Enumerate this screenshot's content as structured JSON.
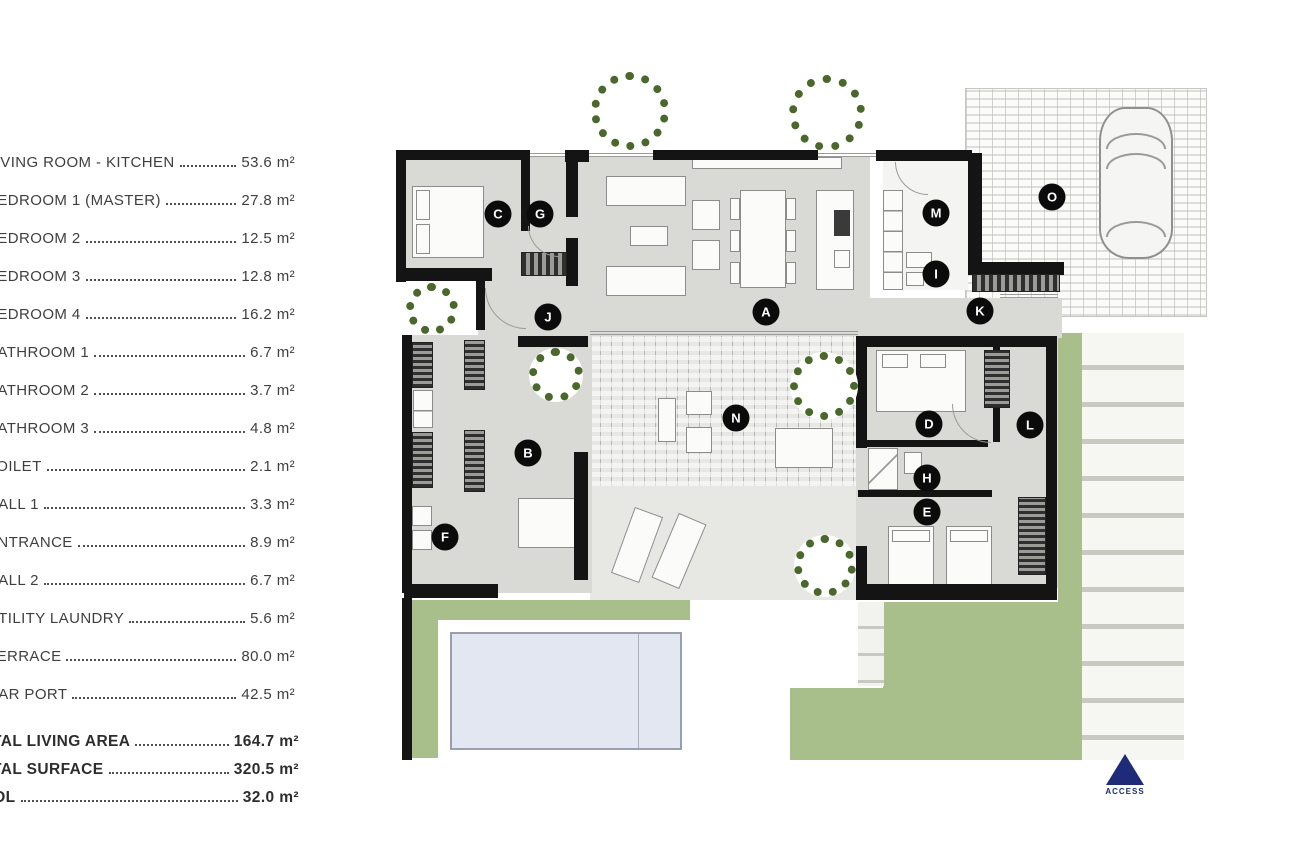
{
  "legend": {
    "unit": "m²",
    "rows": [
      {
        "label": "LIVING ROOM - KITCHEN",
        "value": "53.6 m²"
      },
      {
        "label": "BEDROOM 1 (MASTER)",
        "value": "27.8 m²"
      },
      {
        "label": "BEDROOM 2",
        "value": "12.5 m²"
      },
      {
        "label": "BEDROOM 3",
        "value": "12.8 m²"
      },
      {
        "label": "BEDROOM 4",
        "value": "16.2 m²"
      },
      {
        "label": "BATHROOM 1",
        "value": "6.7 m²"
      },
      {
        "label": "BATHROOM 2",
        "value": "3.7 m²"
      },
      {
        "label": "BATHROOM 3",
        "value": "4.8 m²"
      },
      {
        "label": "TOILET",
        "value": "2.1 m²"
      },
      {
        "label": "HALL 1",
        "value": "3.3 m²"
      },
      {
        "label": "ENTRANCE",
        "value": "8.9 m²"
      },
      {
        "label": "HALL 2",
        "value": "6.7 m²"
      },
      {
        "label": "UTILITY LAUNDRY",
        "value": "5.6 m²"
      },
      {
        "label": "TERRACE",
        "value": "80.0 m²"
      },
      {
        "label": "CAR PORT",
        "value": "42.5 m²"
      }
    ],
    "totals": [
      {
        "label": "TOTAL LIVING AREA",
        "value": "164.7 m²"
      },
      {
        "label": "TOTAL SURFACE",
        "value": "320.5 m²"
      },
      {
        "label": "POOL",
        "value": "32.0 m²"
      }
    ]
  },
  "plan": {
    "markers": [
      {
        "letter": "A",
        "x": 766,
        "y": 312
      },
      {
        "letter": "B",
        "x": 528,
        "y": 453
      },
      {
        "letter": "C",
        "x": 498,
        "y": 214
      },
      {
        "letter": "D",
        "x": 929,
        "y": 424
      },
      {
        "letter": "E",
        "x": 927,
        "y": 512
      },
      {
        "letter": "F",
        "x": 445,
        "y": 537
      },
      {
        "letter": "G",
        "x": 540,
        "y": 214
      },
      {
        "letter": "H",
        "x": 927,
        "y": 478
      },
      {
        "letter": "I",
        "x": 936,
        "y": 274
      },
      {
        "letter": "J",
        "x": 548,
        "y": 317
      },
      {
        "letter": "K",
        "x": 980,
        "y": 311
      },
      {
        "letter": "L",
        "x": 1030,
        "y": 425
      },
      {
        "letter": "M",
        "x": 936,
        "y": 213
      },
      {
        "letter": "N",
        "x": 736,
        "y": 418
      },
      {
        "letter": "O",
        "x": 1052,
        "y": 197
      }
    ],
    "access": {
      "label": "ACCESS"
    }
  },
  "colors": {
    "wall": "#141414",
    "floor": "#d9d9d6",
    "lawn": "#a9bf8b",
    "deck": "#e7e7e4",
    "deck_line": "#b7b7b3",
    "pool": "#e3e7f1",
    "pool_border": "#9aa0ab",
    "tree": "#4a682c",
    "navy": "#1d2b78",
    "furn_border": "#8c8c8c"
  }
}
